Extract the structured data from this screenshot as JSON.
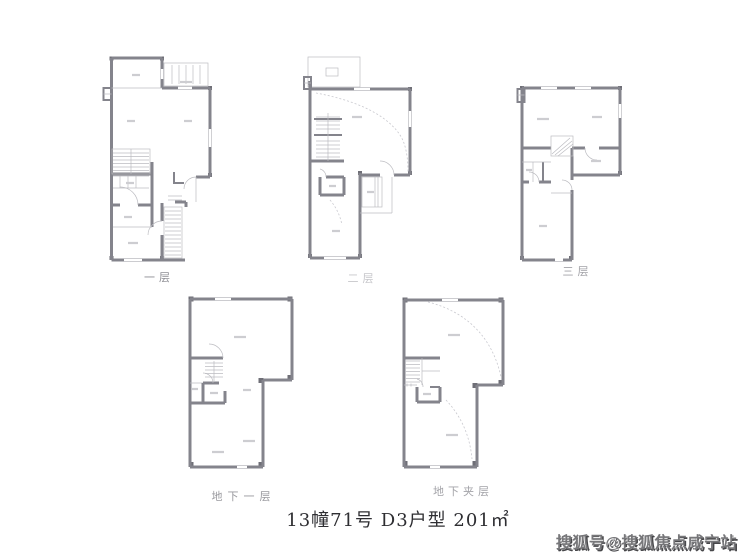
{
  "plans": [
    {
      "id": "level-1",
      "label": "一层"
    },
    {
      "id": "level-2",
      "label": "二层"
    },
    {
      "id": "level-3",
      "label": "三层"
    },
    {
      "id": "basement-1",
      "label": "地下一层"
    },
    {
      "id": "basement-mezzanine",
      "label": "地下夹层"
    }
  ],
  "caption": {
    "text": "13幢71号 D3户型  201㎡"
  },
  "watermark": {
    "text": "搜狐号@搜狐焦点咸宁站"
  },
  "colors": {
    "wall": "#84848c",
    "thin_line": "#bcbcc1",
    "dashed_line": "#c9c9cf",
    "plan_label": "#8f8f95",
    "caption_text": "#2e2e32",
    "watermark_text": "#77777a",
    "background": "#ffffff"
  }
}
